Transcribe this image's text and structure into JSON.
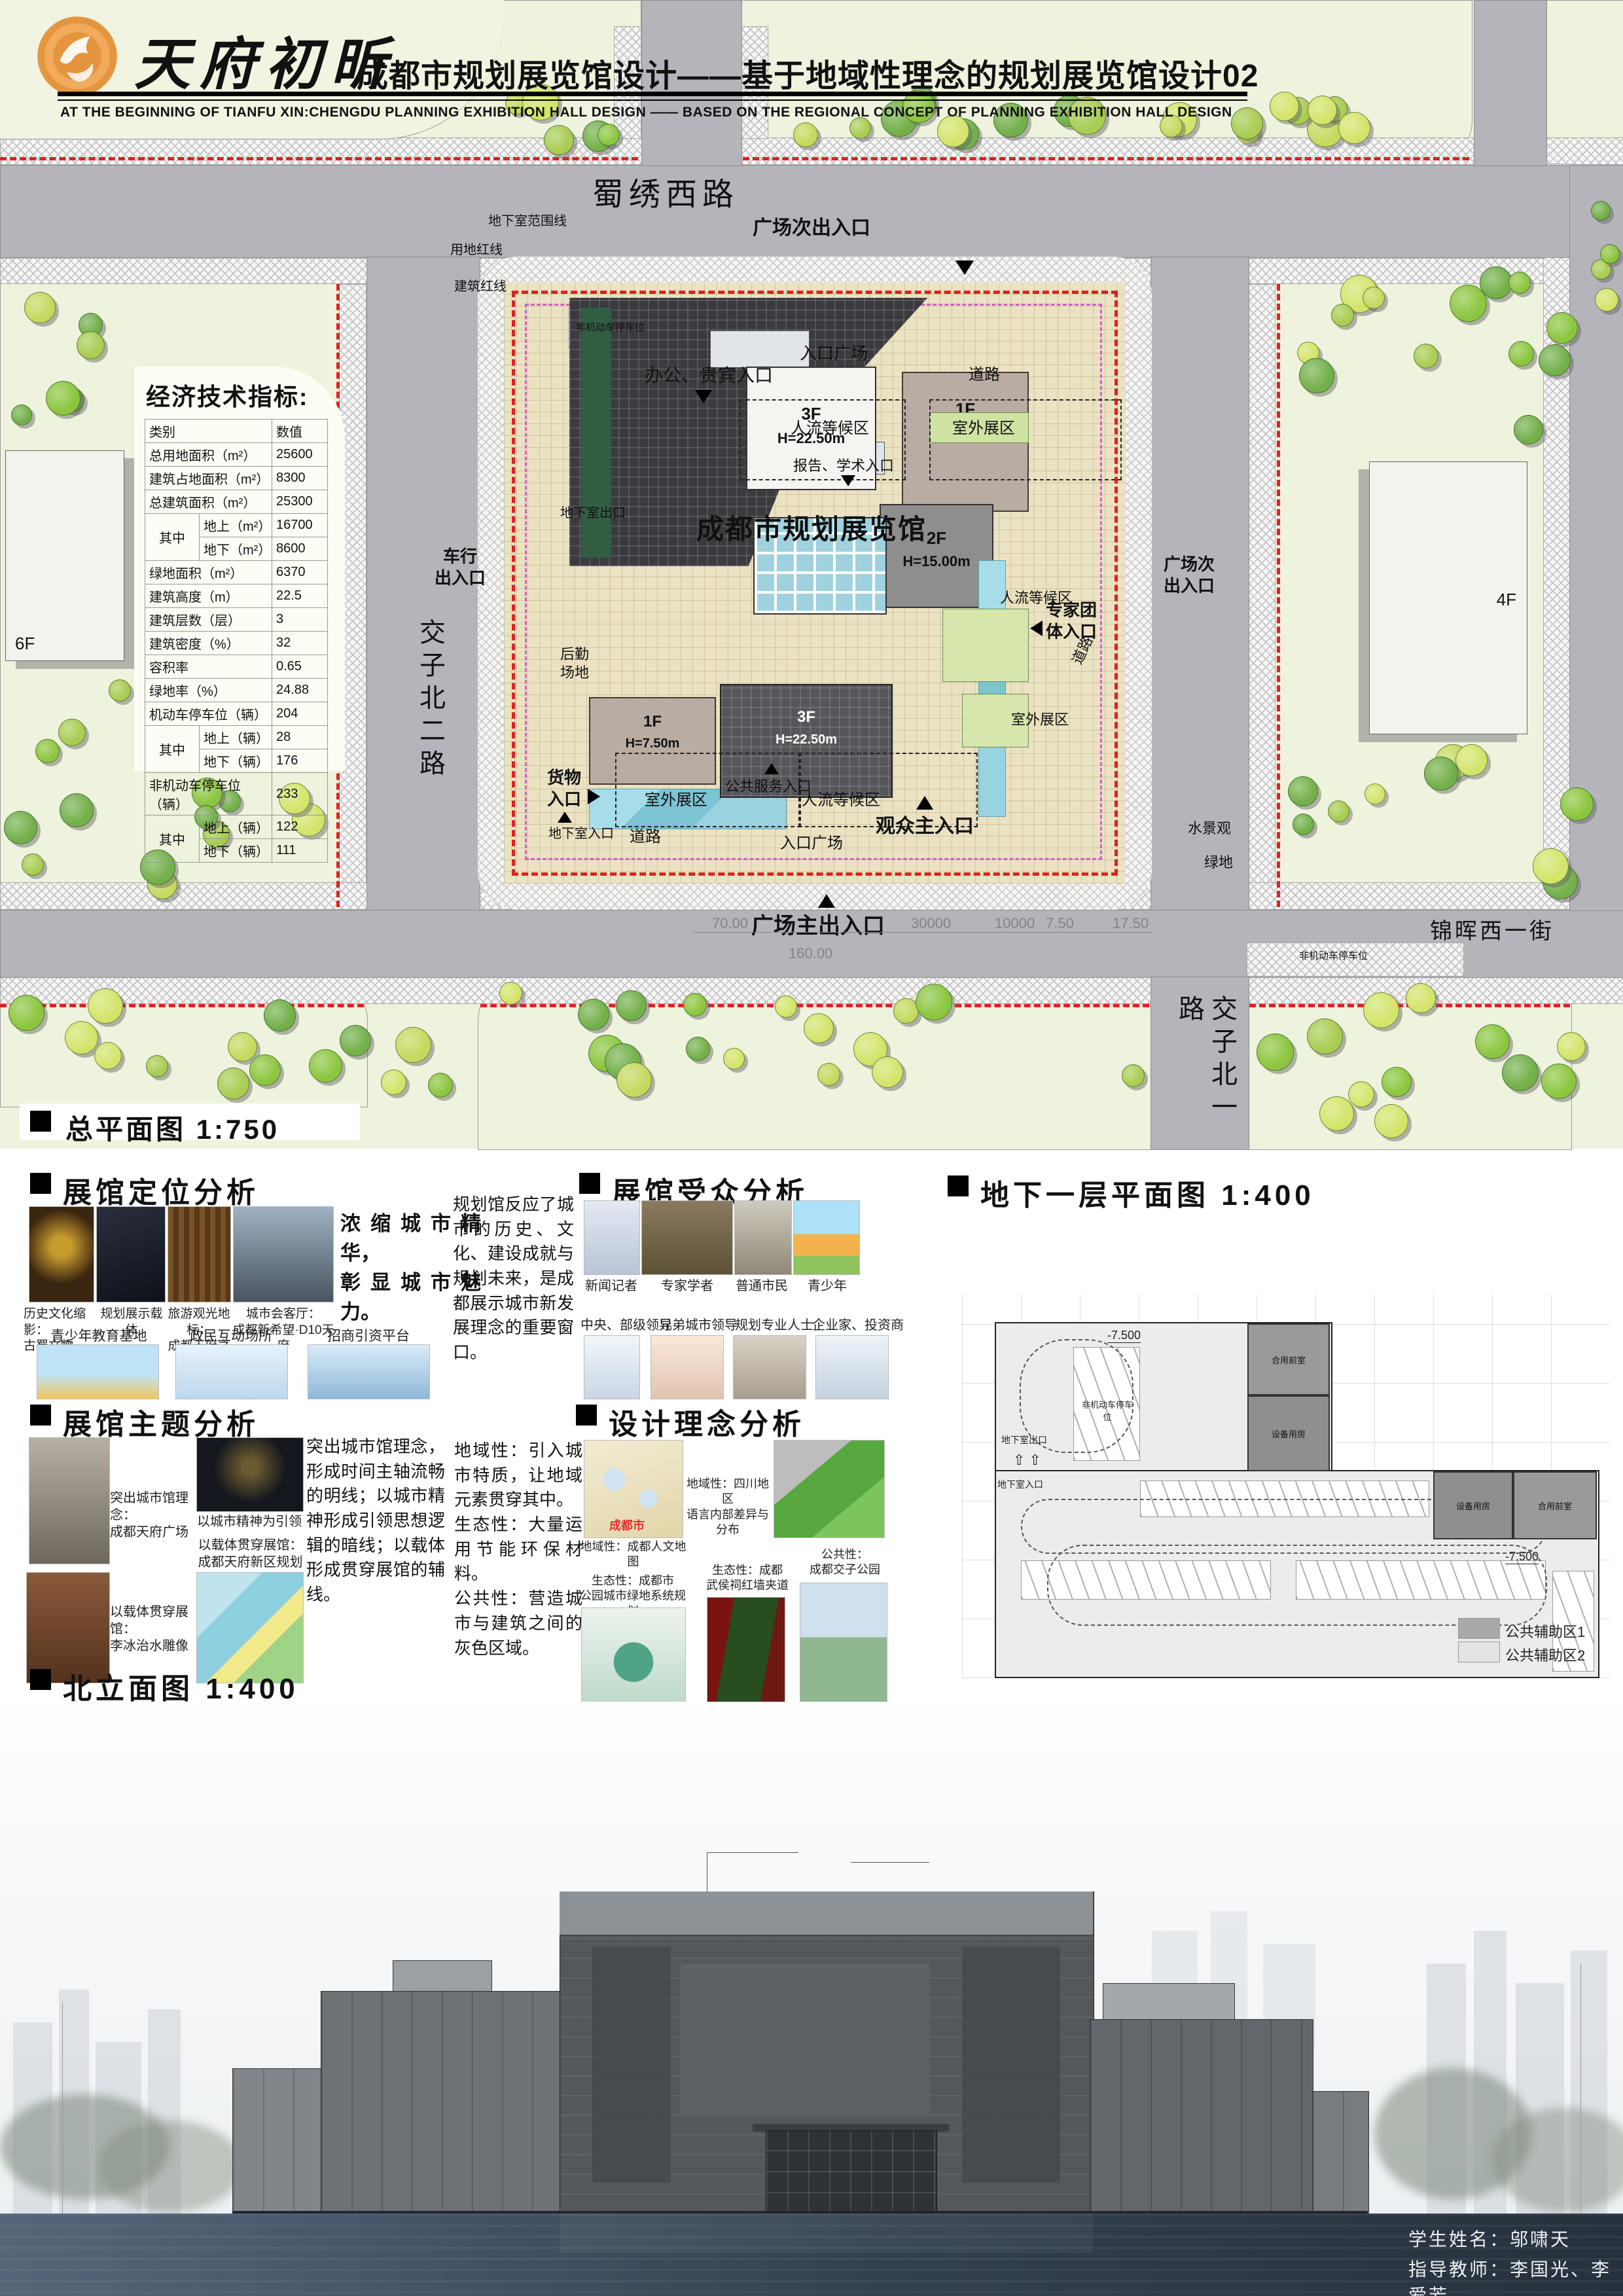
{
  "header": {
    "brand": "天府初昕",
    "title": "成都市规划展览馆设计——基于地域性理念的规划展览馆设计02",
    "subtitle": "AT THE BEGINNING OF TIANFU XIN:CHENGDU PLANNING EXHIBITION HALL DESIGN —— BASED ON THE REGIONAL CONCEPT OF PLANNING EXHIBITION HALL DESIGN"
  },
  "site_plan": {
    "label": "总平面图 1:750",
    "roads": {
      "north": "蜀绣西路",
      "west": "交子北二路",
      "south": "锦晖西一街",
      "east": "交子北一路"
    },
    "building_name": "成都市规划展览馆",
    "nearby": {
      "west_building": "6F",
      "east_building": "4F"
    },
    "masses": {
      "m3f_top": {
        "floor": "3F",
        "height": "H=22.50m"
      },
      "m1f_top": {
        "floor": "1F",
        "height": "H=7.50m"
      },
      "m2f": {
        "floor": "2F",
        "height": "H=15.00m"
      },
      "m1f_bottom": {
        "floor": "1F",
        "height": "H=7.50m"
      },
      "m3f_bottom": {
        "floor": "3F",
        "height": "H=22.50m"
      }
    },
    "labels": {
      "plaza_sub_exit_top": "广场次出入口",
      "plaza_sub_exit_right": "广场次\n出入口",
      "plaza_main_exit": "广场主出入口",
      "vehicle_entry": "车行\n出入口",
      "visitor_main_entry": "观众主入口",
      "office_vip_entry": "办公、贵宾入口",
      "expert_entry": "专家团\n体入口",
      "goods_entry": "货物\n入口",
      "public_service_entry": "公共服务入口",
      "report_entry": "报告、学术入口",
      "basement_exit": "地下室出口",
      "basement_entry": "地下室入口",
      "entry_plaza": "入口广场",
      "road": "道路",
      "outdoor_zone": "室外展区",
      "waiting_zone": "人流等候区",
      "logistics_yard": "后勤\n场地",
      "water_feature": "水景观",
      "green_space": "绿地",
      "basement_extent": "地下室范围线",
      "land_redline": "用地红线",
      "building_redline": "建筑红线",
      "bike_parking": "非机动车停车位"
    },
    "dims": {
      "a": "70.00",
      "b": "160.00",
      "c": "30000",
      "d": "10000",
      "e": "7.50",
      "f": "17.50"
    },
    "table": {
      "title": "经济技术指标:",
      "col_headers": [
        "类别",
        "数值"
      ],
      "rows": [
        {
          "label": "总用地面积（m²）",
          "value": "25600"
        },
        {
          "label": "建筑占地面积（m²）",
          "value": "8300"
        },
        {
          "label": "总建筑面积（m²）",
          "value": "25300"
        },
        {
          "group": "其中",
          "sub": [
            [
              "地上（m²）",
              "16700"
            ],
            [
              "地下（m²）",
              "8600"
            ]
          ]
        },
        {
          "label": "绿地面积（m²）",
          "value": "6370"
        },
        {
          "label": "建筑高度（m）",
          "value": "22.5"
        },
        {
          "label": "建筑层数（层）",
          "value": "3"
        },
        {
          "label": "建筑密度（%）",
          "value": "32"
        },
        {
          "label": "容积率",
          "value": "0.65"
        },
        {
          "label": "绿地率（%）",
          "value": "24.88"
        },
        {
          "label": "机动车停车位（辆）",
          "value": "204"
        },
        {
          "group": "其中",
          "sub": [
            [
              "地上（辆）",
              "28"
            ],
            [
              "地下（辆）",
              "176"
            ]
          ]
        },
        {
          "label": "非机动车停车位（辆）",
          "value": "233"
        },
        {
          "group": "其中",
          "sub": [
            [
              "地上（辆）",
              "122"
            ],
            [
              "地下（辆）",
              "111"
            ]
          ]
        }
      ]
    }
  },
  "sections": {
    "positioning": {
      "title": "展馆定位分析",
      "summary": "浓缩城市精华，\n彰显城市魅力。",
      "row1": [
        {
          "caption": "历史文化缩影：\n古蜀文物"
        },
        {
          "caption": "规划展示载体"
        },
        {
          "caption": "旅游观光地标：\n成都天府之檐"
        },
        {
          "caption": "城市会客厅：\n成都新希望·D10天府"
        }
      ],
      "row2": [
        {
          "caption": "青少年教育基地"
        },
        {
          "caption": "政民互动场所"
        },
        {
          "caption": "招商引资平台"
        }
      ]
    },
    "audience": {
      "title": "展馆受众分析",
      "intro": "规划馆反应了城市的历史、文化、建设成就与规划未来，是成都展示城市新发展理念的重要窗口。",
      "row1": [
        {
          "caption": "新闻记者"
        },
        {
          "caption": "专家学者"
        },
        {
          "caption": "普通市民"
        },
        {
          "caption": "青少年"
        }
      ],
      "row2": [
        {
          "caption": "中央、部级领导"
        },
        {
          "caption": "兄弟城市领导"
        },
        {
          "caption": "规划专业人士"
        },
        {
          "caption": "企业家、投资商"
        }
      ]
    },
    "theme": {
      "title": "展馆主题分析",
      "text": "突出城市馆理念，形成时间主轴流畅的明线；以城市精神形成引领思想逻辑的暗线；以载体形成贯穿展馆的辅线。",
      "cap_city": "突出城市馆理念：\n成都天府广场",
      "cap_spirit": "以城市精神为引领",
      "cap_map": "以载体贯穿展馆：\n成都天府新区规划图",
      "cap_statue": "以载体贯穿展馆：\n李冰治水雕像"
    },
    "concept": {
      "title": "设计理念分析",
      "text": "地域性：引入城市特质，让地域元素贯穿其中。\n生态性：大量运用节能环保材料。\n公共性：营造城市与建筑之间的灰色区域。",
      "cap_culture_map": "地域性：成都人文地图",
      "chengdu_tag": "成都市",
      "cap_language": "地域性：四川地区\n语言内部差异与分布",
      "cap_green": "生态性：成都市\n公园城市绿地系统规划",
      "cap_redwall": "生态性：成都\n武侯祠红墙夹道",
      "cap_park": "公共性：\n成都交子公园"
    },
    "basement": {
      "title": "地下一层平面图 1:400",
      "level": "-7.500",
      "room_front": "合用前室",
      "room_equip": "设备用房",
      "exit": "地下室出口",
      "entry": "地下室入口",
      "bike": "非机动车停车位",
      "legend": [
        {
          "label": "公共辅助区1"
        },
        {
          "label": "公共辅助区2"
        }
      ]
    },
    "elevation": {
      "title": "北立面图 1:400"
    }
  },
  "footer": {
    "student": "学生姓名：邬啸天",
    "advisors": "指导教师：李国光、李爱芳"
  },
  "colors": {
    "redline": "#e31f1f",
    "road": "#b4b4ba",
    "plaza": "#eae2c2",
    "accent_orange": "#e6953f"
  }
}
